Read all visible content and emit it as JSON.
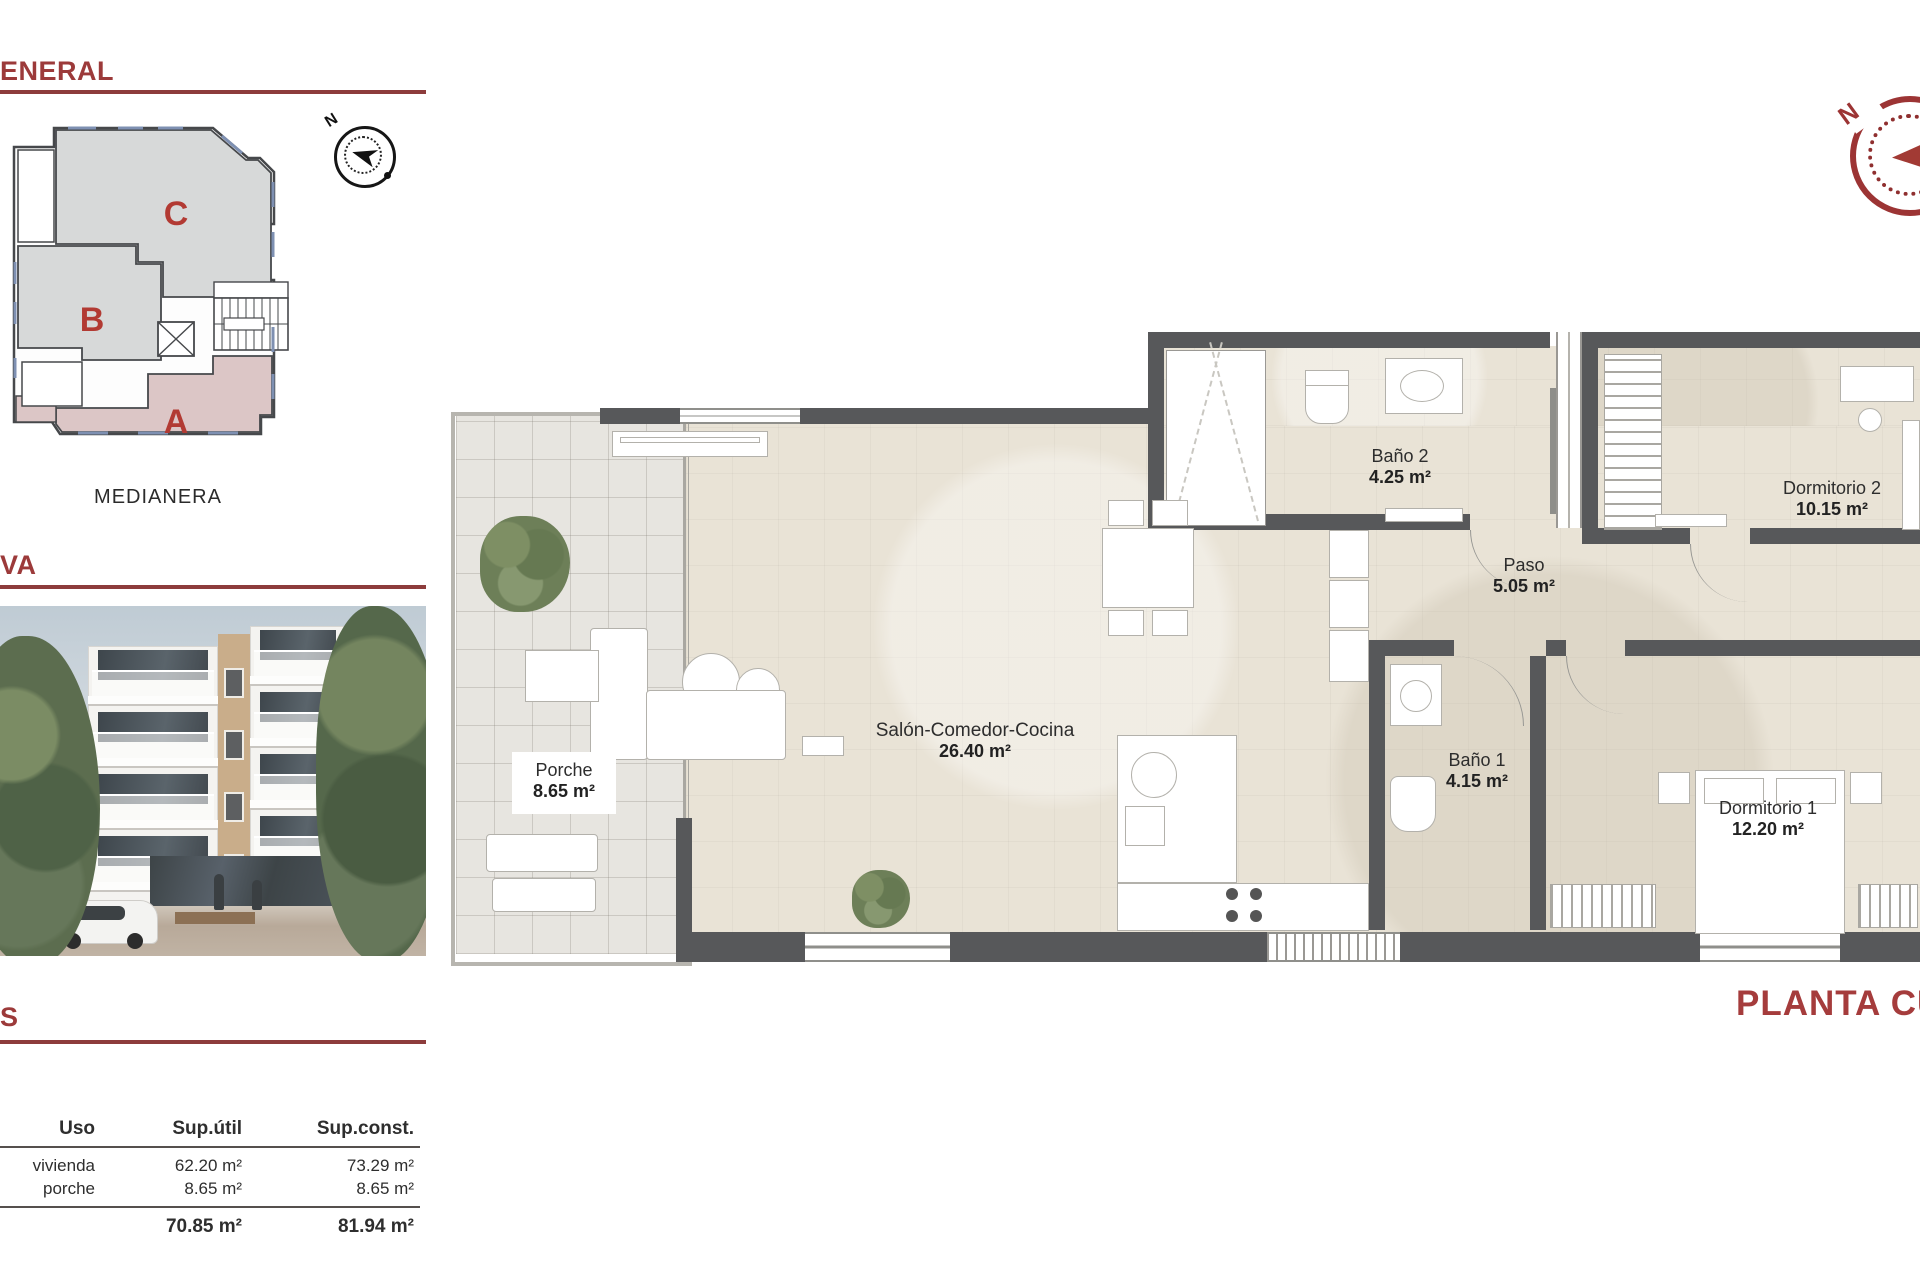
{
  "headings": {
    "general": "ENERAL",
    "views": "VA",
    "areas": "S"
  },
  "key_plan": {
    "unit_a": "A",
    "unit_b": "B",
    "unit_c": "C",
    "boundary_label": "MEDIANERA",
    "north_label": "N"
  },
  "compass": {
    "north_label": "N"
  },
  "areas_table": {
    "col_uso": "Uso",
    "col_util": "Sup.útil",
    "col_const": "Sup.const.",
    "rows": [
      {
        "uso": "vivienda",
        "util": "62.20 m²",
        "const": "73.29 m²"
      },
      {
        "uso": "porche",
        "util": "8.65 m²",
        "const": "8.65 m²"
      }
    ],
    "total_util": "70.85 m²",
    "total_const": "81.94 m²"
  },
  "plan": {
    "title": "PLANTA CUA",
    "rooms": {
      "bano2": {
        "name": "Baño 2",
        "area": "4.25 m²"
      },
      "paso": {
        "name": "Paso",
        "area": "5.05 m²"
      },
      "dorm2": {
        "name": "Dormitorio 2",
        "area": "10.15 m²"
      },
      "salon": {
        "name": "Salón-Comedor-Cocina",
        "area": "26.40 m²"
      },
      "porche": {
        "name": "Porche",
        "area": "8.65 m²"
      },
      "bano1": {
        "name": "Baño 1",
        "area": "4.15 m²"
      },
      "dorm1": {
        "name": "Dormitorio 1",
        "area": "12.20 m²"
      }
    }
  },
  "colors": {
    "accent_red": "#9c3a3a",
    "wall_gray": "#57585a",
    "floor_beige": "#e9e3d6",
    "unit_highlight": "#dcc6c6",
    "unit_neutral": "#d7d9d9",
    "letter_red": "#b23a33"
  }
}
